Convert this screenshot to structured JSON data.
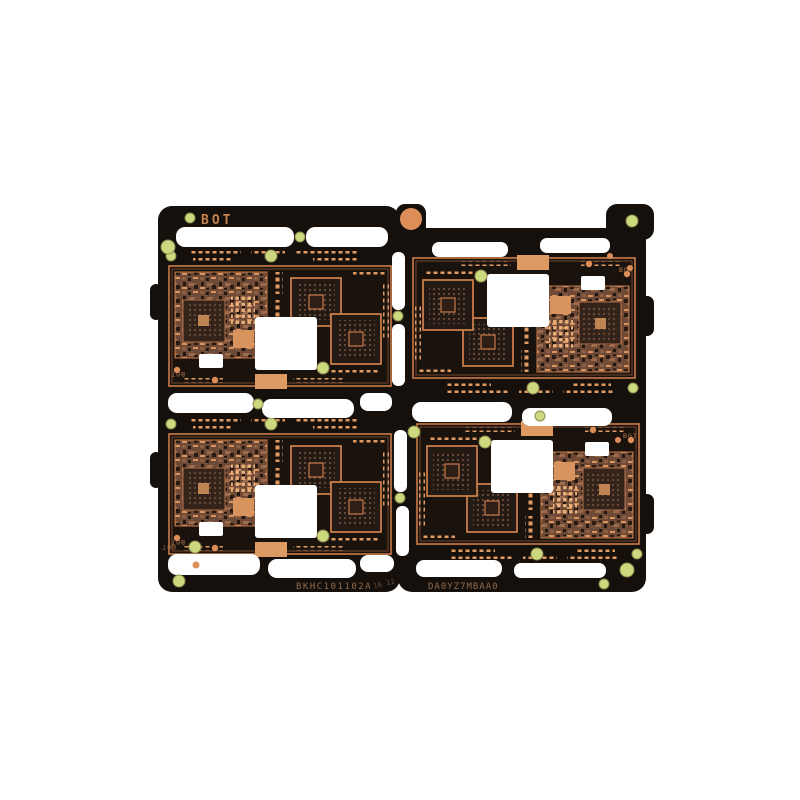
{
  "scene": {
    "type": "product-photo",
    "subject": "Panelized smartphone PCB array, 2x2 units, black solder mask with exposed copper pads and routed white slots",
    "background": "#ffffff"
  },
  "markings": {
    "bot": "BOT",
    "serial_left": "BKHC101102A",
    "serial_left_small": "16 12",
    "serial_right": "DA0YZ7MBAA0"
  },
  "colors": {
    "solder_mask": "#15100c",
    "board_interior": "#1a120d",
    "copper_trace": "#c87c49",
    "copper_pad": "#e09a62",
    "copper_zone": "#6f4a36",
    "bga_dark": "#241a14",
    "fiducial_green": "#ccd97e",
    "tooling_dot": "#dd8d58",
    "cutout": "#ffffff"
  }
}
